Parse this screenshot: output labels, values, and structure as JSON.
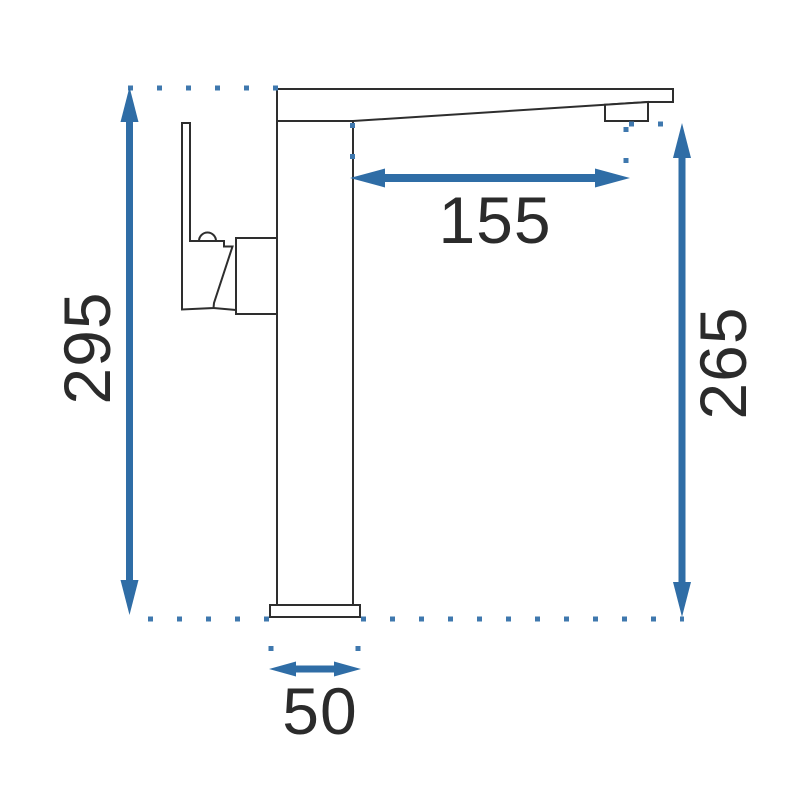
{
  "drawing": {
    "title": "faucet-side-elevation-dimension-diagram",
    "dimensions": {
      "total_height": {
        "value": "295"
      },
      "spout_reach": {
        "value": "155"
      },
      "outlet_height": {
        "value": "265"
      },
      "base_width": {
        "value": "50"
      }
    },
    "colors": {
      "dimension_accent": "#2f6da6",
      "extension_dots": "#3f78ae",
      "outline": "#2e2e2e",
      "label_text": "#2b2b2b",
      "background": "#ffffff"
    }
  }
}
